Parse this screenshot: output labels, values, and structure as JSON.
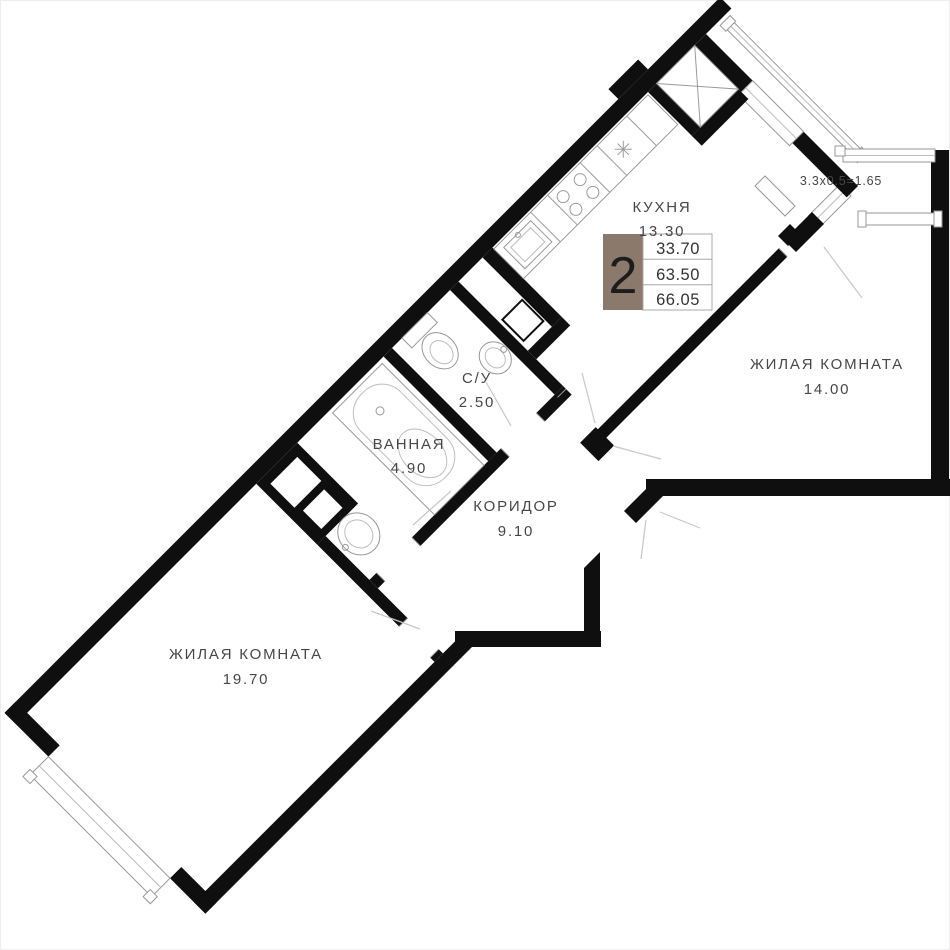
{
  "legend": {
    "rooms_count": "2",
    "living_area": "33.70",
    "area_without_balcony": "63.50",
    "total_area": "66.05"
  },
  "balcony": {
    "note": "3.3x0.5=1.65"
  },
  "rooms": {
    "kitchen": {
      "name": "КУХНЯ",
      "area": "13.30"
    },
    "living14": {
      "name": "ЖИЛАЯ КОМНАТА",
      "area": "14.00"
    },
    "su": {
      "name": "С/У",
      "area": "2.50"
    },
    "bathroom": {
      "name": "ВАННАЯ",
      "area": "4.90"
    },
    "corridor": {
      "name": "КОРИДОР",
      "area": "9.10"
    },
    "living19": {
      "name": "ЖИЛАЯ КОМНАТА",
      "area": "19.70"
    }
  },
  "colors": {
    "wall": "#0f0f0f",
    "accent_brown": "#8b7a6b",
    "line_gray": "#9a9a9a",
    "text_gray": "#474747",
    "background": "#ffffff"
  },
  "fixtures": [
    "bathtub",
    "toilet",
    "bath-sink",
    "su-sink",
    "kitchen-sink",
    "stove",
    "fridge-slot",
    "vent-shaft",
    "radiator",
    "entrance-door",
    "balcony-door",
    "windows"
  ]
}
